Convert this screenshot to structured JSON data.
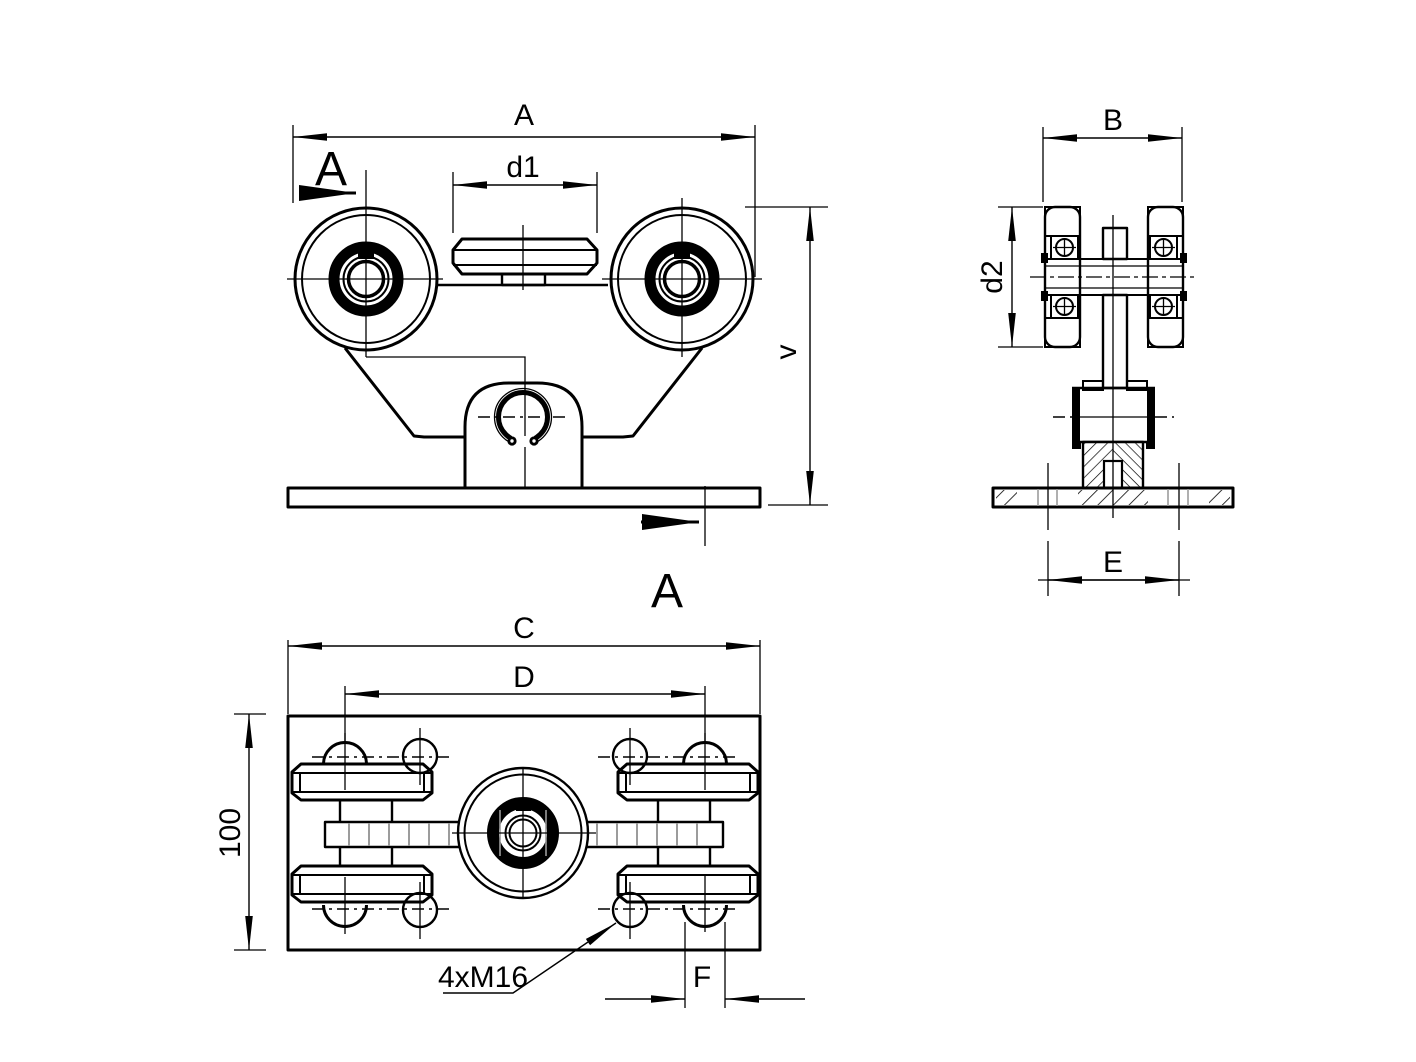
{
  "drawing": {
    "type": "technical-drawing",
    "subject": "gate-trolley-roller-assembly",
    "background_color": "#ffffff",
    "line_color": "#000000",
    "thin_line_color": "#9c9c9c",
    "views": {
      "front_view": "front-elevation",
      "side_view": "section-A-A",
      "plan_view": "bottom-plan"
    },
    "labels": {
      "dim_A": "A",
      "dim_d1": "d1",
      "dim_v": "v",
      "dim_B": "B",
      "dim_d2": "d2",
      "dim_E": "E",
      "dim_C": "C",
      "dim_D": "D",
      "dim_100": "100",
      "dim_F": "F",
      "thread_note": "4xM16",
      "section_label_top": "A",
      "section_label_bottom": "A"
    }
  }
}
